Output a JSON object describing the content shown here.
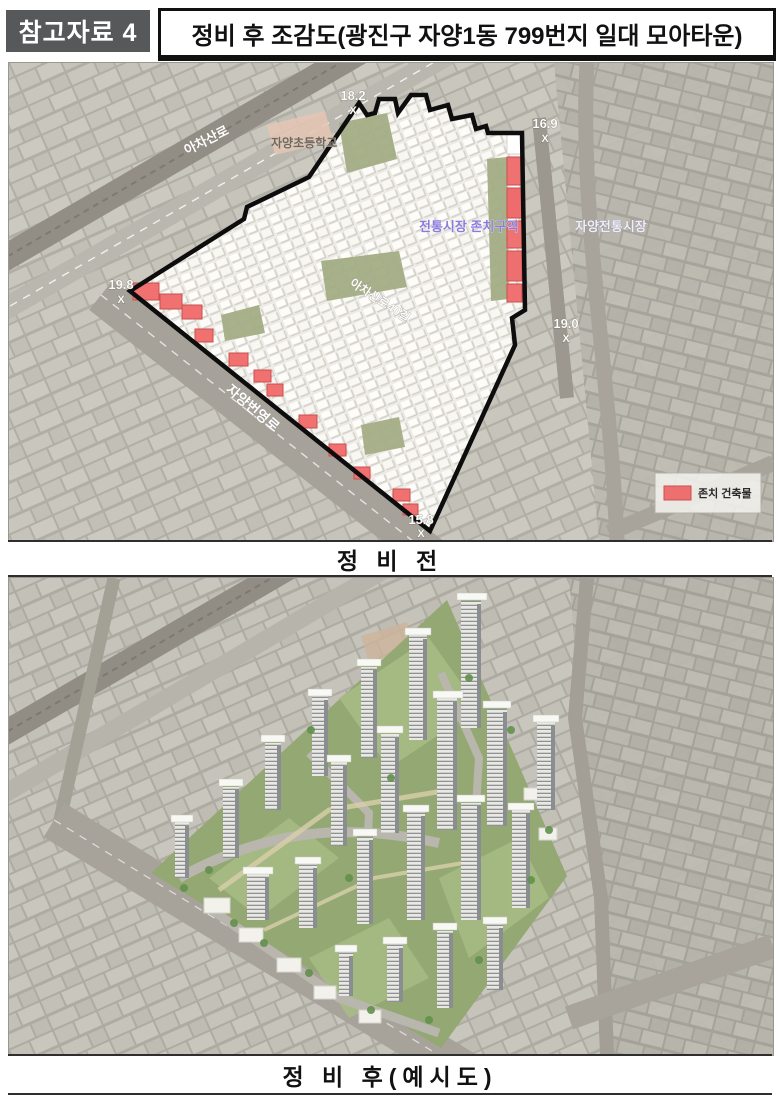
{
  "header": {
    "badge": "참고자료 4",
    "title": "정비 후 조감도(광진구 자양1동 799번지 일대 모아타운)"
  },
  "before_map": {
    "caption": "정 비 전",
    "roads": {
      "achasan": "아차산로",
      "achasan40": "아차산로40길",
      "beonyeong": "자양번영로"
    },
    "places": {
      "school": "자양초등학교",
      "market": "자양전통시장"
    },
    "zone_label": "전통시장 존치구역",
    "markers": [
      {
        "value": "18.2",
        "symbol": "X"
      },
      {
        "value": "16.9",
        "symbol": "X"
      },
      {
        "value": "19.8",
        "symbol": "X"
      },
      {
        "value": "19.0",
        "symbol": "X"
      },
      {
        "value": "15.8",
        "symbol": "X"
      }
    ],
    "legend": {
      "label": "존치 건축물",
      "swatch_color": "#ee6f6f"
    }
  },
  "after_map": {
    "caption": "정 비 후(예시도)"
  },
  "colors": {
    "badge_bg": "#57585a",
    "retained_red": "#ee6f6f",
    "boundary_black": "#0d0d0d",
    "zone_text_purple": "#8a7cdc",
    "site_green": "#93a873",
    "city_gray": "#b1aea5"
  }
}
